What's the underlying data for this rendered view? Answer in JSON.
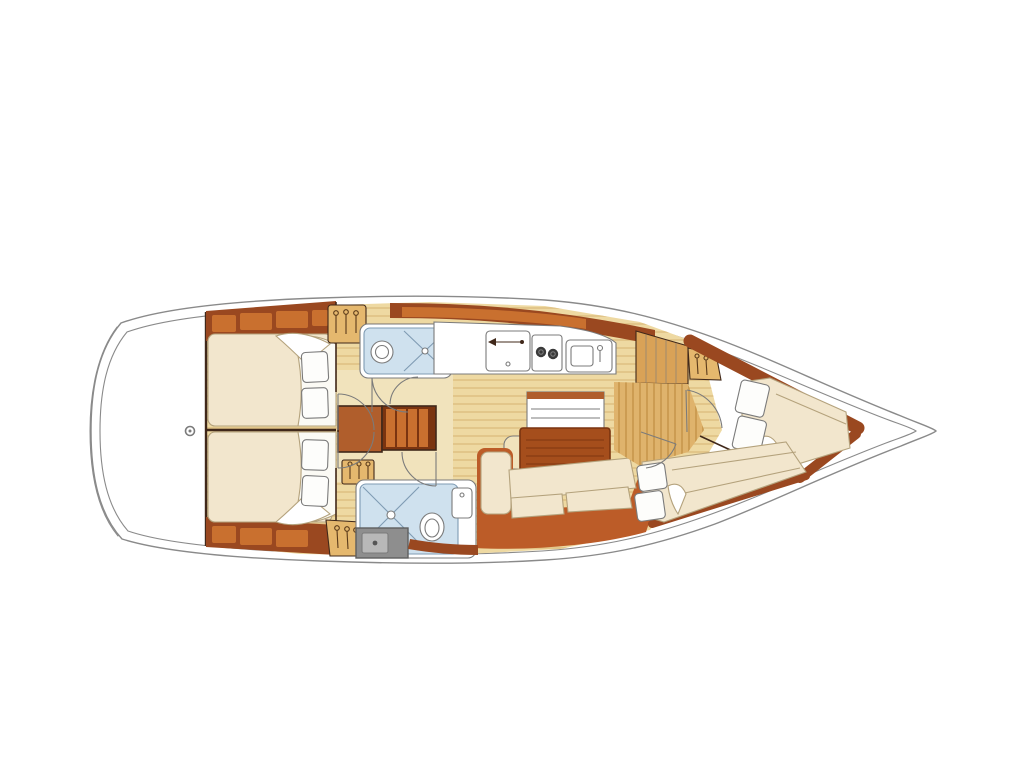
{
  "figure": {
    "description": "Overhead interior layout plan of a sailing yacht, bow pointing right",
    "view": "top-down floor plan",
    "bow_direction": "right",
    "cabin_count": 4,
    "head_count": 2
  },
  "rooms": [
    {
      "id": "cockpit-stern",
      "name": "stern deck / transom",
      "features": [
        "pedestal"
      ]
    },
    {
      "id": "aft-cabin-port",
      "name": "aft double cabin (top/port)",
      "features": [
        "double berth",
        "pillows",
        "lockers",
        "wardrobe"
      ]
    },
    {
      "id": "aft-cabin-starboard",
      "name": "aft double cabin (bottom/starboard)",
      "features": [
        "double berth",
        "pillows",
        "lockers",
        "wardrobe"
      ]
    },
    {
      "id": "aft-head",
      "name": "aft head (port)",
      "features": [
        "toilet",
        "shower",
        "sink"
      ]
    },
    {
      "id": "galley",
      "name": "galley (port side)",
      "features": [
        "refrigerator",
        "two-burner stove",
        "sink",
        "counter",
        "lockers"
      ]
    },
    {
      "id": "companionway",
      "name": "companionway steps and engine box",
      "features": [
        "ladder steps"
      ]
    },
    {
      "id": "saloon",
      "name": "saloon",
      "features": [
        "table",
        "folding leaf",
        "stool",
        "L-settee",
        "cushions",
        "mast post"
      ]
    },
    {
      "id": "forward-head",
      "name": "forward head (starboard)",
      "features": [
        "shower stall",
        "toilet",
        "sink",
        "shower tray",
        "hanging locker"
      ]
    },
    {
      "id": "forward-cabin-port",
      "name": "forward cabin (port, angled berth)",
      "features": [
        "double berth",
        "pillows",
        "wardrobe",
        "door"
      ]
    },
    {
      "id": "forward-cabin-starboard",
      "name": "forward cabin (starboard, angled berth)",
      "features": [
        "double berth",
        "pillows",
        "door"
      ]
    }
  ],
  "colors": {
    "hull_line": "#8a8a8a",
    "detail_gray": "#7b7b7b",
    "bulkhead_dark": "#40281a",
    "wood_dark": "#9a4820",
    "wood_mid": "#b05e2c",
    "locker_orange": "#c9702f",
    "cabinet_tan": "#d9a257",
    "wardrobe_tan": "#e5b86e",
    "sole_base": "#eed9a2",
    "sole_line": "#ddbe7f",
    "corridor_base": "#dfb36c",
    "corridor_line": "#c28f43",
    "vestibule_cream": "#f1e3bc",
    "upholstery_cream": "#f2e6cd",
    "upholstery_line": "#b4a27c",
    "sheet_white": "#fbfaf4",
    "pillow_white": "#fdfdfb",
    "bathroom_blue": "#cfe1ee",
    "bathroom_line": "#7f9bb3",
    "settee_terracotta": "#bc5c28",
    "table_wood": "#a54e1c",
    "table_line": "#7a3410",
    "tray_gray": "#8e8e8e",
    "tray_inner": "#b8b8b8",
    "burner_dark": "#3a3a3a"
  }
}
